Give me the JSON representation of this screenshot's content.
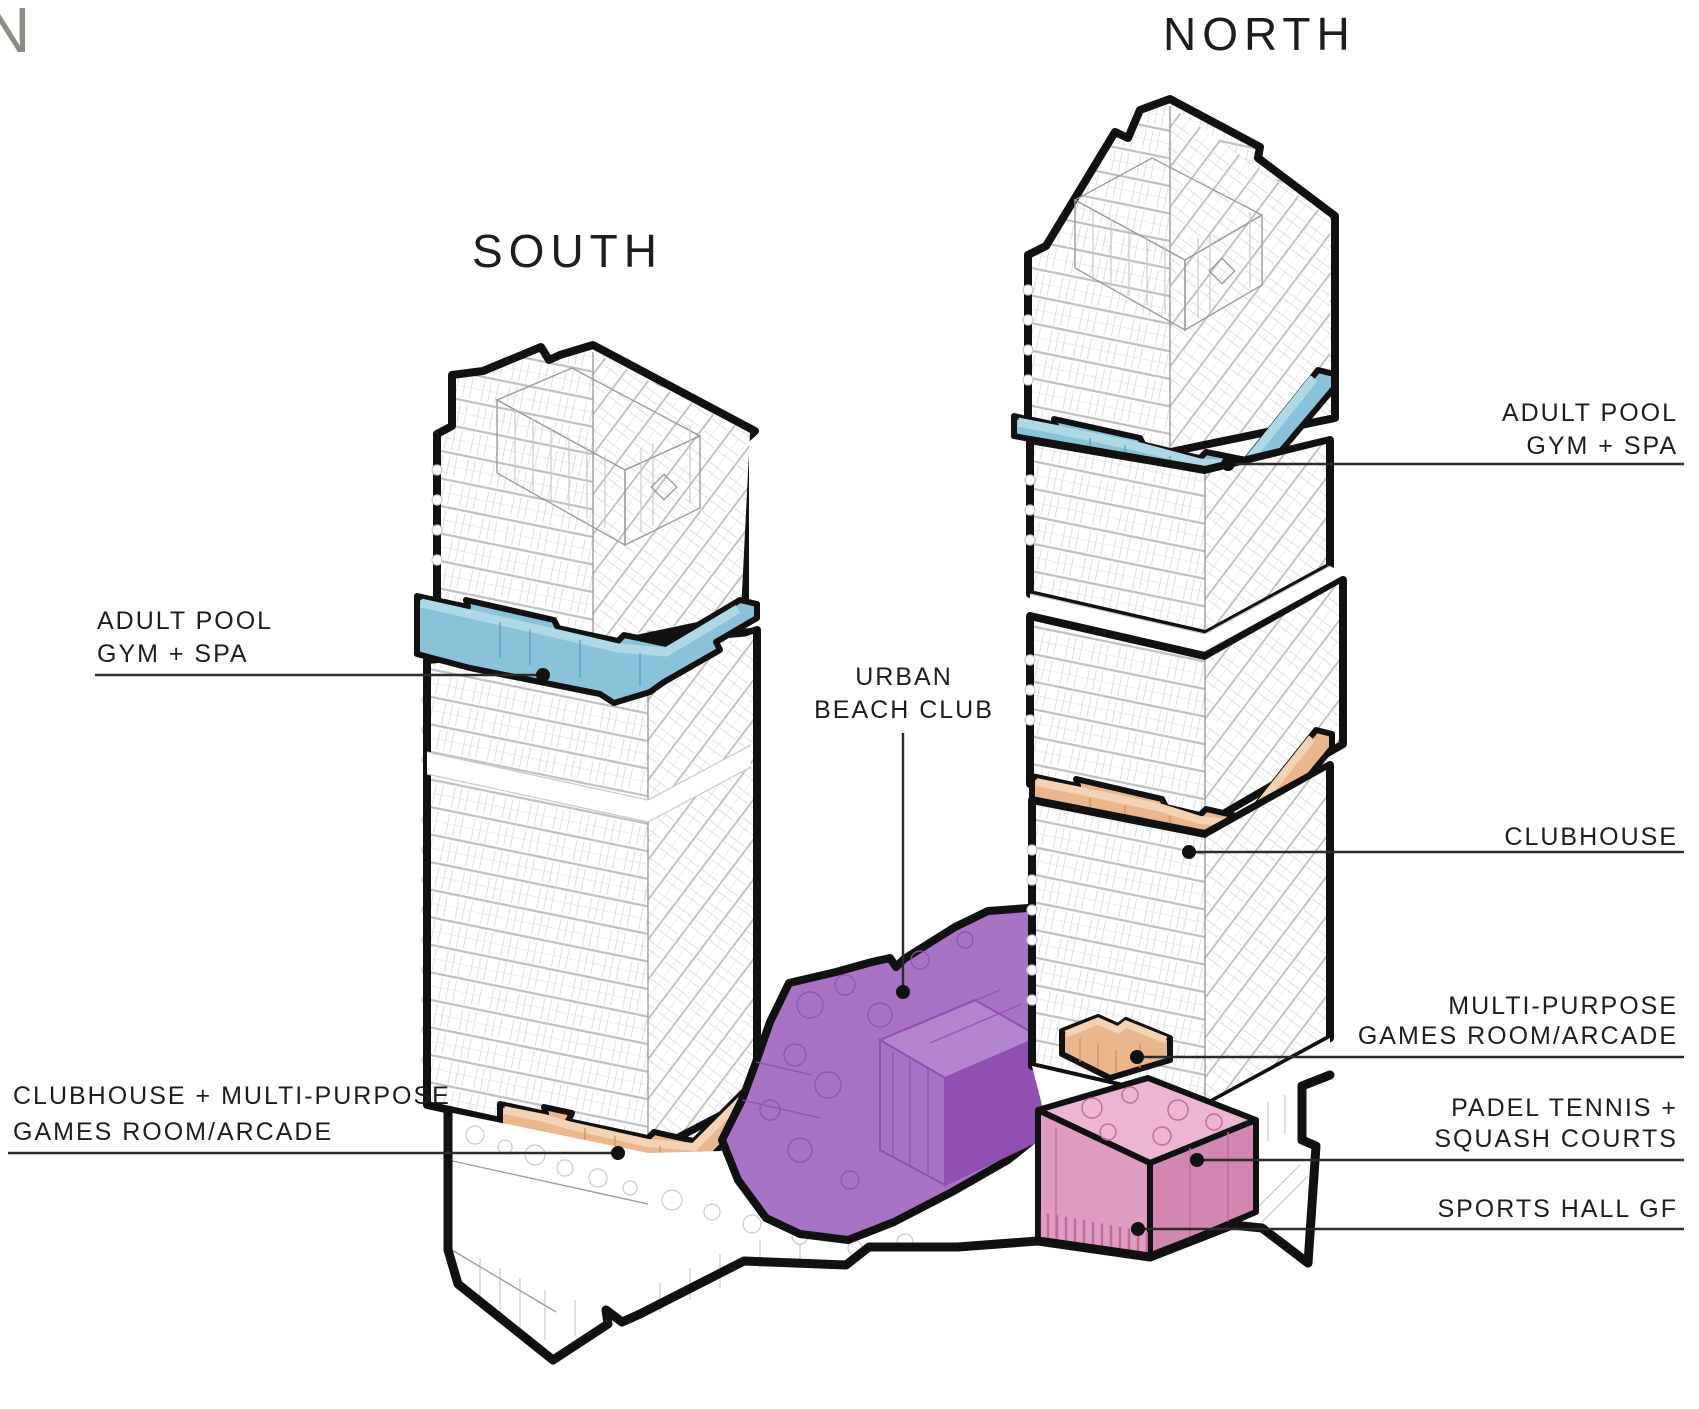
{
  "titles": {
    "partial_letter": "N",
    "south_tower": "SOUTH",
    "north_tower": "NORTH"
  },
  "annotations": {
    "adult_pool_south": {
      "line1": "ADULT POOL",
      "line2": "GYM + SPA"
    },
    "adult_pool_north": {
      "line1": "ADULT POOL",
      "line2": "GYM + SPA"
    },
    "urban_beach_club": {
      "line1": "URBAN",
      "line2": "BEACH CLUB"
    },
    "clubhouse_north": {
      "label": "CLUBHOUSE"
    },
    "games_room_north": {
      "line1": "MULTI-PURPOSE",
      "line2": "GAMES ROOM/ARCADE"
    },
    "padel": {
      "line1": "PADEL TENNIS +",
      "line2": "SQUASH COURTS"
    },
    "sports_hall": {
      "label": "SPORTS HALL GF"
    },
    "clubhouse_games_south": {
      "line1": "CLUBHOUSE +  MULTI-PURPOSE",
      "line2": "GAMES ROOM/ARCADE"
    }
  },
  "zones": [
    {
      "name": "Adult Pool / Gym + Spa",
      "color": "#8AC2D9"
    },
    {
      "name": "Clubhouse",
      "color": "#E9B68D"
    },
    {
      "name": "Urban Beach Club",
      "color": "#A873C4"
    },
    {
      "name": "Multi-Purpose Games Room/Arcade",
      "color": "#E9B68D"
    },
    {
      "name": "Padel Tennis + Squash Courts / Sports Hall GF",
      "color": "#DE9CC3"
    }
  ],
  "colors": {
    "blue": "#8AC2D9",
    "blue_light": "#AED8E6",
    "orange": "#E9B68D",
    "orange_light": "#F3D3B4",
    "purple": "#A873C4",
    "purple_dark": "#8F50B2",
    "purple_light": "#B285CD",
    "pink": "#DE9CC3",
    "pink_top": "#ECB6D2",
    "pink_dark": "#D287B3",
    "pink_stripe": "#BF6BA0",
    "outline": "#111111",
    "leader": "#2B2B2B",
    "text": "#1D1D1B",
    "muted": "#8D8C82"
  }
}
